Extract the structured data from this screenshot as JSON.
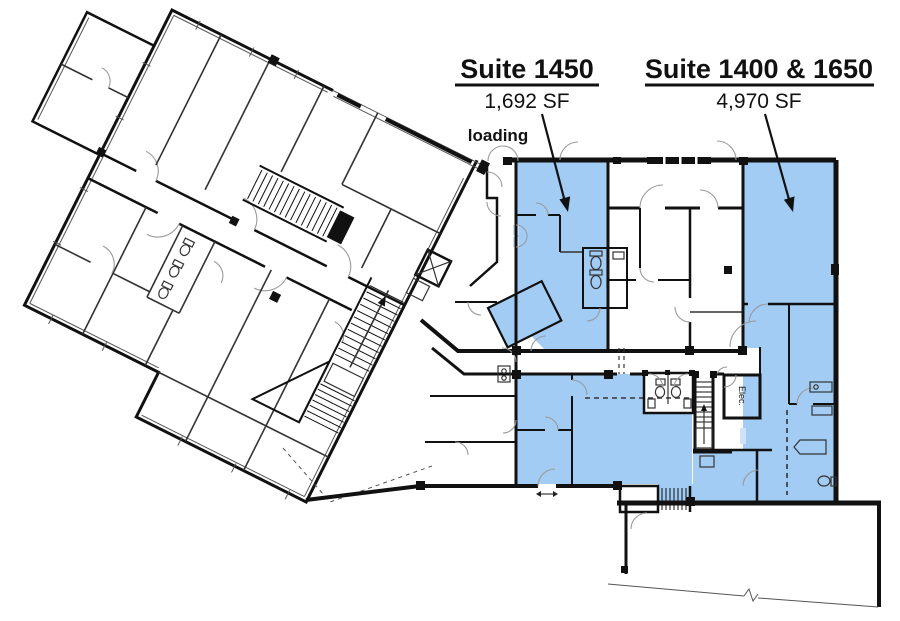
{
  "suites": [
    {
      "name": "Suite 1450",
      "area": "1,692 SF"
    },
    {
      "name": "Suite 1400 & 1650",
      "area": "4,970 SF"
    }
  ],
  "annotations": {
    "loading": "loading",
    "electrical_room": "Elec."
  },
  "colors": {
    "highlight": "#A2CCF4",
    "highlight_soft": "#CFE3F8",
    "wall": "#111111",
    "door_arc": "#9a9a9a"
  }
}
